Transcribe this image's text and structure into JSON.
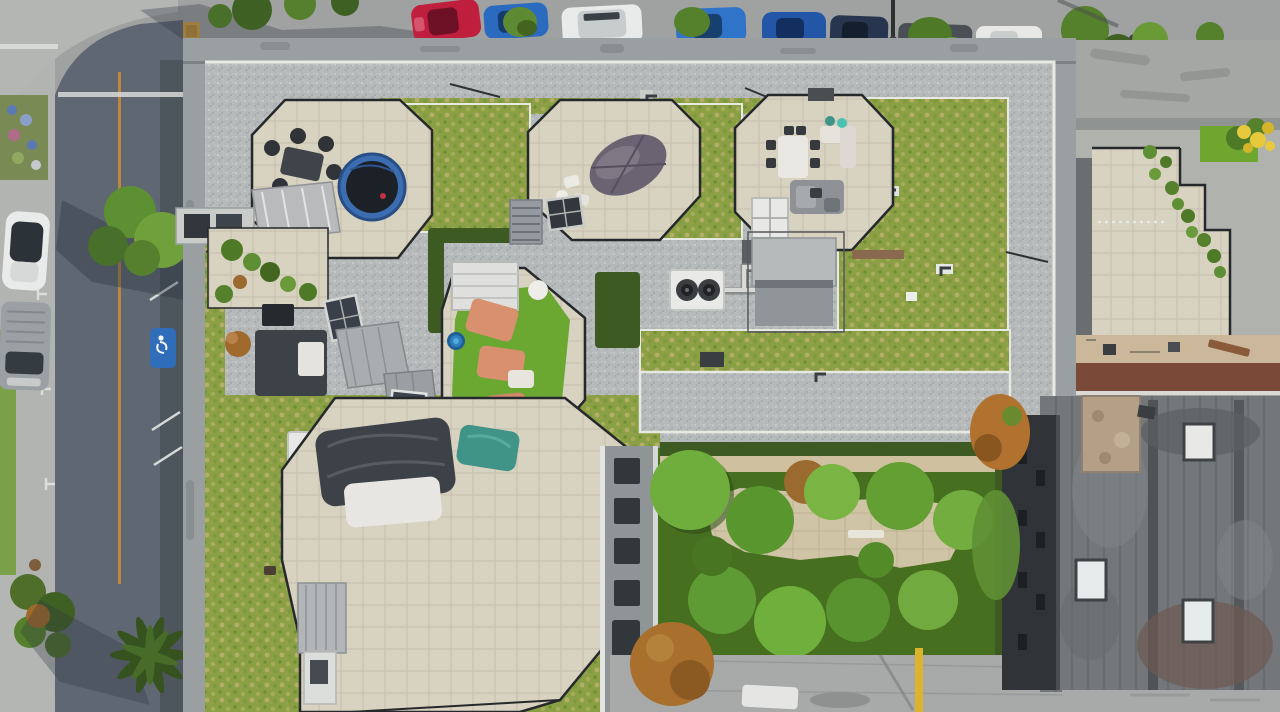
{
  "meta": {
    "type": "aerial-photograph",
    "description": "Top-down drone view of a condo building rooftop with octagonal railed patio terraces, sedum green-roof areas, gravel ballast roof, a landscaped interior courtyard, surrounding streets with parked cars, and neighboring flat-roof buildings."
  },
  "palette": {
    "asphalt_light": "#9fa2a0",
    "asphalt_dark": "#5f6872",
    "sidewalk": "#b2b4b1",
    "wall": "#9aa0a2",
    "wall_edge": "#7d8284",
    "gravel": "#b6b9ba",
    "white_border": "#e9e9e4",
    "sedum": "#8ba044",
    "lawn": "#6fa62f",
    "hedge": "#3d5a22",
    "pavers": "#d8d2c0",
    "plaza": "#cfc5a6",
    "turf": "#6aa832",
    "lounger": "#d9906f",
    "teal_tarp": "#3f9387",
    "tarp_dark": "#3d4248",
    "boat_tarp": "#6a6472",
    "charcoal": "#303438",
    "old_roof": "#73777a",
    "tan_patch": "#b3a086",
    "skylight_glass": "#31373d",
    "skylight_white": "#e8e9e6",
    "penthouse": "#b6babb",
    "awning": "#90959a",
    "hvac_white": "#e9eae8",
    "fan_dark": "#3b3e41",
    "fan_rust": "#9a5a2a",
    "trampoline_ring": "#3b6db0",
    "trampoline_mat": "#1c2128",
    "red_car": "#bf1f3c",
    "blue_car": "#2a6bc0",
    "blue_car2": "#2456a8",
    "navy_car": "#27364e",
    "white_car": "#e9ebea",
    "gray_van": "#9aa0a4",
    "dark_van": "#4a4f55",
    "center_line": "#c08a3e",
    "road_mark": "#dfe1de",
    "handicap_blue": "#2f6fbe",
    "yellow_pole": "#d9b42c",
    "yellow_flowers": "#e6c93c",
    "tactile_yellow": "#d8a43c",
    "tree_green": "#5f9b34",
    "tree_light": "#77b13e",
    "tree_dark": "#3f6023",
    "tree_orange": "#a8702c",
    "red_walkway": "#7a4938",
    "alley_tan": "#cbb89a",
    "facade": "#8f9497",
    "window_dark": "#32373c",
    "shed_gray": "#b8babc",
    "shadow": "#2b3340"
  },
  "scene": {
    "streets": {
      "left_street_markings": [
        "double-T parking stall ticks",
        "orange centre line",
        "accessible parking stencil",
        "white diagonal hatch",
        "stop bars"
      ],
      "vehicles_left": [
        {
          "name": "white-hatchback",
          "color": "#e9ebea"
        },
        {
          "name": "gray-van",
          "color": "#9aa0a4"
        }
      ],
      "vehicles_top": [
        {
          "name": "red-sedan",
          "color": "#bf1f3c"
        },
        {
          "name": "blue-sedan",
          "color": "#2a6bc0"
        },
        {
          "name": "white-suv",
          "color": "#e9ebea"
        },
        {
          "name": "blue-sedan-2",
          "color": "#2f74c8"
        },
        {
          "name": "blue-sedan-3",
          "color": "#2456a8"
        },
        {
          "name": "navy-sedan",
          "color": "#27364e"
        },
        {
          "name": "dark-gray-van",
          "color": "#4a4f55"
        },
        {
          "name": "white-van",
          "color": "#e8e9e7"
        },
        {
          "name": "gray-sedan",
          "color": "#9fa3a6"
        },
        {
          "name": "white-van-far",
          "color": "#e9eaea"
        }
      ]
    },
    "rooftop": {
      "patios": [
        {
          "name": "patio-northwest",
          "features": [
            "dark dining set",
            "blue trampoline",
            "slanted gray shed",
            "glass railing"
          ]
        },
        {
          "name": "patio-north-middle",
          "features": [
            "tarp-covered boat",
            "white chairs",
            "skylight"
          ]
        },
        {
          "name": "patio-northeast",
          "features": [
            "white dining table",
            "gray lounge set",
            "teal exercise balls",
            "white skylight"
          ]
        },
        {
          "name": "patio-turf",
          "features": [
            "artificial turf",
            "salmon loungers",
            "white pergola",
            "blue kiddie pool",
            "round table"
          ]
        },
        {
          "name": "patio-southwest",
          "features": [
            "tarped furniture",
            "teal tarp",
            "white cover",
            "standing-seam shed"
          ]
        }
      ],
      "equipment": [
        "twin-fan HVAC with pipes",
        "penthouse mechanical room",
        "triple rust-fan unit",
        "skylights",
        "roof drains"
      ],
      "surfaces": [
        "gravel ballast",
        "sedum green roof",
        "beige pavers",
        "dark hedges"
      ]
    },
    "courtyard": {
      "features": [
        "tree canopies",
        "beige paver plaza",
        "benches",
        "orange autumn tree",
        "yellow bollard",
        "balcony facade"
      ]
    },
    "neighbors": {
      "east_terrace": [
        "potted plants along railing",
        "yellow flowering shrub",
        "lawn patch",
        "red-brown walkway"
      ],
      "southeast_building": [
        "stained dark flat roof",
        "white skylights",
        "tan roof patch",
        "charcoal facade"
      ]
    }
  }
}
